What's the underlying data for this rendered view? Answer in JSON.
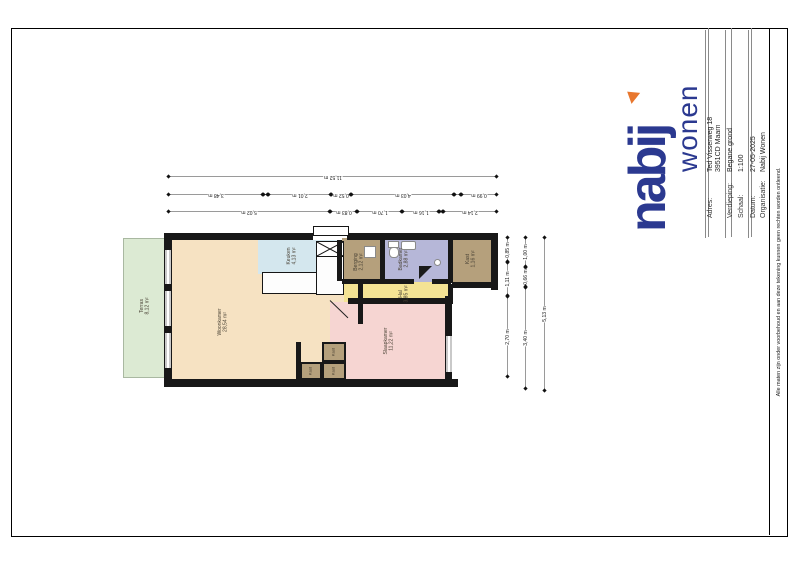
{
  "colors": {
    "navy": "#2b3990",
    "orange": "#e8772e",
    "wall": "#181818",
    "terras": "#dcead3",
    "woonkamer": "#f6e2c2",
    "keuken": "#d4e7ee",
    "berging": "#b5a07c",
    "badkamer": "#b6b7d8",
    "kast": "#b5a07c",
    "hal": "#f4e394",
    "slaapkamer": "#f6d5d2"
  },
  "title_block": {
    "logo": {
      "word1": "nabij",
      "word2": "wonen"
    },
    "fields": [
      {
        "label": "Adres:",
        "value": "Ted Visserweg 18",
        "value2": "3951CD Maarn"
      },
      {
        "label": "Verdieping:",
        "value": "Begane grond"
      },
      {
        "label": "Schaal:",
        "value": "1:100"
      },
      {
        "label": "Datum:",
        "value": "27-05-2025"
      },
      {
        "label": "Organisatie:",
        "value": "Nabij Wonen"
      }
    ]
  },
  "disclaimer": "Alle maten zijn onder voorbehoud en aan deze tekening kunnen geen rechten worden ontleend.",
  "rooms": {
    "terras": {
      "name": "Terras",
      "area": "8,12 m²"
    },
    "woonkamer": {
      "name": "Woonkamer",
      "area": "28,54 m²"
    },
    "keuken": {
      "name": "Keuken",
      "area": "4,13 m²"
    },
    "berging": {
      "name": "Berging",
      "area": "2,12 m²"
    },
    "badkamer": {
      "name": "Badkamer",
      "area": "2,88 m²"
    },
    "kast_hal": {
      "name": "Kast",
      "area": "1,16 m²"
    },
    "hal": {
      "name": "Hal",
      "area": "3,85 m²"
    },
    "slaapkamer": {
      "name": "Slaapkamer",
      "area": "11,22 m²"
    },
    "kast_small": {
      "name": "Kast"
    }
  },
  "dimensions": {
    "top": {
      "row1": [
        "11,52 m"
      ],
      "row2": [
        "3,48 m",
        "2,01 m",
        "0,52 m",
        "4,03 m",
        "0,99 m"
      ],
      "row3": [
        "5,02 m",
        "0,83 m",
        "1,70 m",
        "1,16 m",
        "2,14 m"
      ]
    },
    "right": {
      "col1": [
        "0,85 m",
        "1,11 m",
        "2,70 m"
      ],
      "col2": [
        "1,00 m",
        "0,66 m",
        "3,40 m"
      ],
      "col3": [
        "5,13 m"
      ]
    }
  }
}
